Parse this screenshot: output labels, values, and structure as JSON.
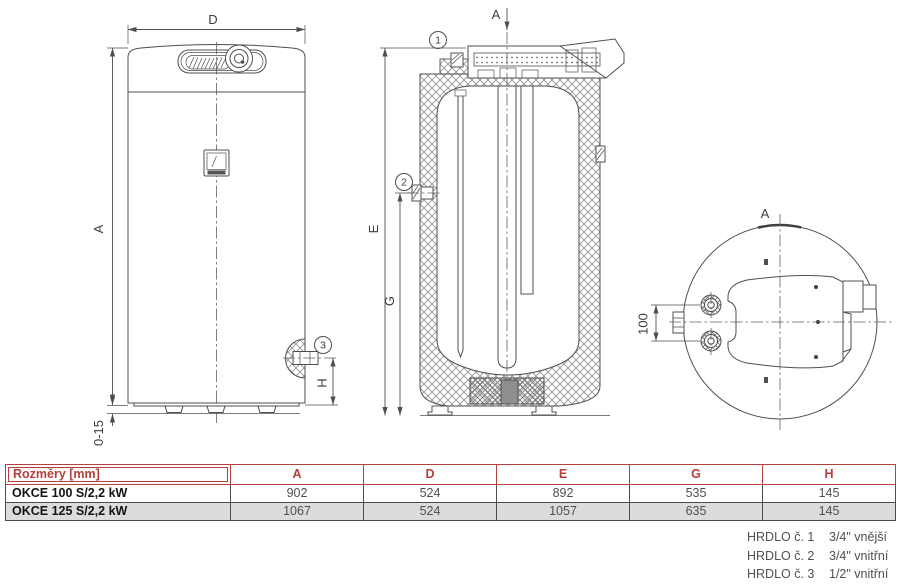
{
  "drawing": {
    "front": {
      "dim_d": "D",
      "dim_a": "A",
      "dim_h": "H",
      "dim_feet": "0-15",
      "callout": "3"
    },
    "section": {
      "view_arrow": "A",
      "dim_e": "E",
      "dim_g": "G",
      "callout_top": "1",
      "callout_side": "2"
    },
    "top_view": {
      "view_label": "A",
      "dim_ports": "100"
    }
  },
  "table": {
    "corner": "Rozměry [mm]",
    "columns": [
      "A",
      "D",
      "E",
      "G",
      "H"
    ],
    "rows": [
      {
        "model": "OKCE 100 S/2,2 kW",
        "values": [
          "902",
          "524",
          "892",
          "535",
          "145"
        ]
      },
      {
        "model": "OKCE 125 S/2,2 kW",
        "values": [
          "1067",
          "524",
          "1057",
          "635",
          "145"
        ]
      }
    ]
  },
  "notes": [
    {
      "label": "HRDLO č. 1",
      "spec": "3/4\" vnější"
    },
    {
      "label": "HRDLO č. 2",
      "spec": "3/4\" vnitřní"
    },
    {
      "label": "HRDLO č. 3",
      "spec": "1/2\" vnitřní"
    }
  ],
  "colors": {
    "accent": "#b5403c",
    "line": "#4f4f4f",
    "alt_row": "#dcdcdc",
    "note_text": "#515154"
  }
}
